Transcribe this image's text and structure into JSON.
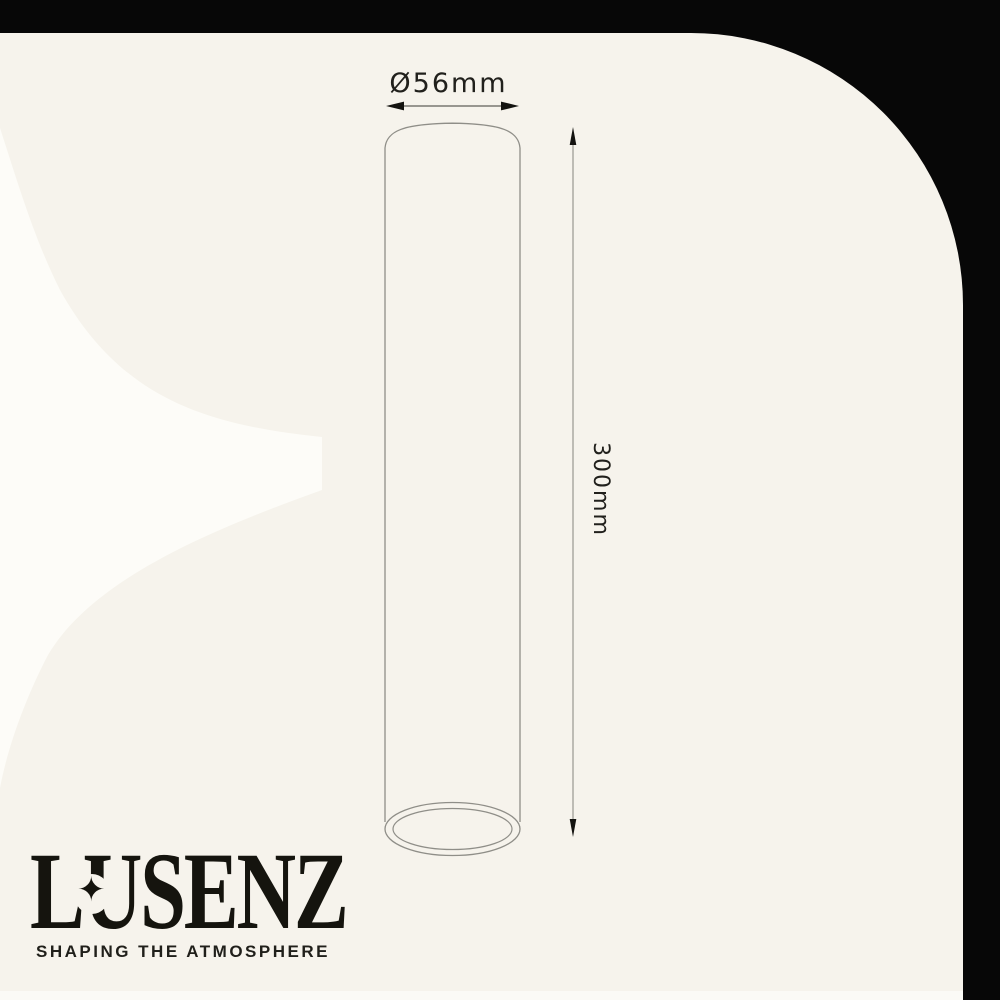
{
  "brand": {
    "name": "LUSENZ",
    "tagline": "SHAPING THE ATMOSPHERE",
    "star_icon": "✦"
  },
  "diagram": {
    "type": "technical-dimension-drawing",
    "product": "cylinder tube light fixture",
    "diameter_label": "Ø56mm",
    "height_label": "300mm",
    "diameter_mm": 56,
    "height_mm": 300
  },
  "colors": {
    "background": "#070707",
    "panel": "#f6f3ec",
    "watermark": "#fdfcf8",
    "line_art": "#8f8e88",
    "ink": "#15140e"
  }
}
